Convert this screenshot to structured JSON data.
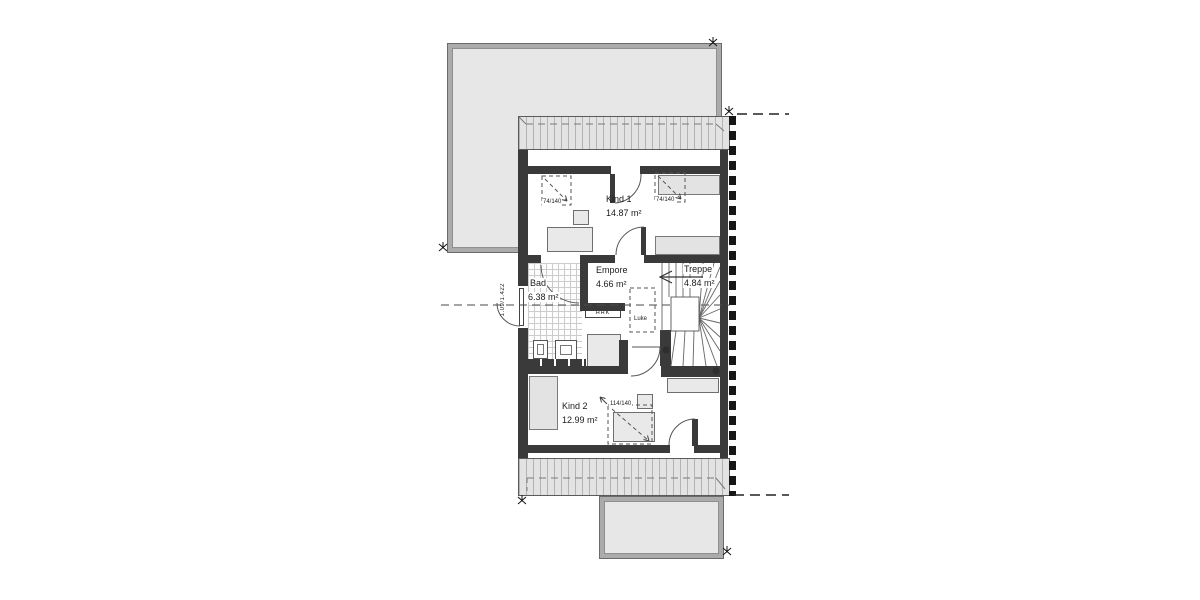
{
  "plan": {
    "title": "Dachgeschoss Grundriss",
    "rooms": [
      {
        "id": "kind1",
        "name": "Kind 1",
        "area": "14.87 m²"
      },
      {
        "id": "empore",
        "name": "Empore",
        "area": "4.66 m²"
      },
      {
        "id": "treppe",
        "name": "Treppe",
        "area": "4.84 m²"
      },
      {
        "id": "bad",
        "name": "Bad",
        "area": "6.38 m²"
      },
      {
        "id": "kind2",
        "name": "Kind 2",
        "area": "12.99 m²"
      }
    ],
    "annotations": {
      "skylight_small_left": "74/140",
      "skylight_small_right": "74/140",
      "skylight_large": "114/140",
      "hatch_label": "Luke",
      "radiator_label": "HHK",
      "window_dim": "1.09/1.422"
    },
    "icons": [
      "stair-direction-arrow",
      "survey-marker-icon",
      "skylight-diagonal-arrow"
    ],
    "colors": {
      "wall": "#3a3a3a",
      "roof_band": "#e3e3e3",
      "lower_roof": "#e7e7e7",
      "furniture": "#e9e9e9",
      "line": "#555555",
      "background": "#ffffff"
    }
  }
}
